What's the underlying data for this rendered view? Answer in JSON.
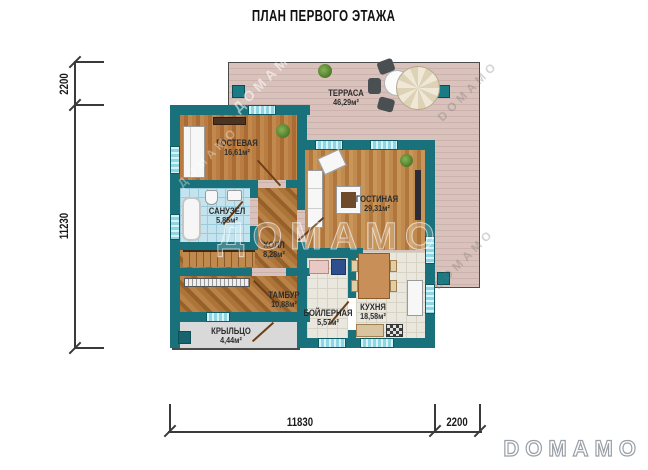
{
  "title": "ПЛАН ПЕРВОГО ЭТАЖА",
  "rooms": [
    {
      "name": "ТЕРРАСА",
      "area": "46,29м²"
    },
    {
      "name": "ГОСТЕВАЯ",
      "area": "16,61м²"
    },
    {
      "name": "САНУЗЕЛ",
      "area": "5,85м²"
    },
    {
      "name": "ХОЛЛ",
      "area": "8,28м²"
    },
    {
      "name": "ГОСТИНАЯ",
      "area": "29,31м²"
    },
    {
      "name": "ТАМБУР",
      "area": "10,88м²"
    },
    {
      "name": "БОЙЛЕРНАЯ",
      "area": "5,57м²"
    },
    {
      "name": "КУХНЯ",
      "area": "18,58м²"
    },
    {
      "name": "КРЫЛЬЦО",
      "area": "4,44м²"
    }
  ],
  "dimensions": {
    "left_top": "2200",
    "left_main": "11230",
    "bottom_main": "11830",
    "bottom_right": "2200"
  },
  "watermark": {
    "cyrillic": "ДОМАМО",
    "latin": "DOMAMO"
  },
  "colors": {
    "wall": "#19717b",
    "terrace_deck": "#d8c1bb",
    "wood_floor": "#b0743c",
    "bath_tile": "#c3e4ee",
    "light_tile": "#eae7df",
    "window": "#8fd5e3",
    "porch": "#d9d9d9"
  }
}
